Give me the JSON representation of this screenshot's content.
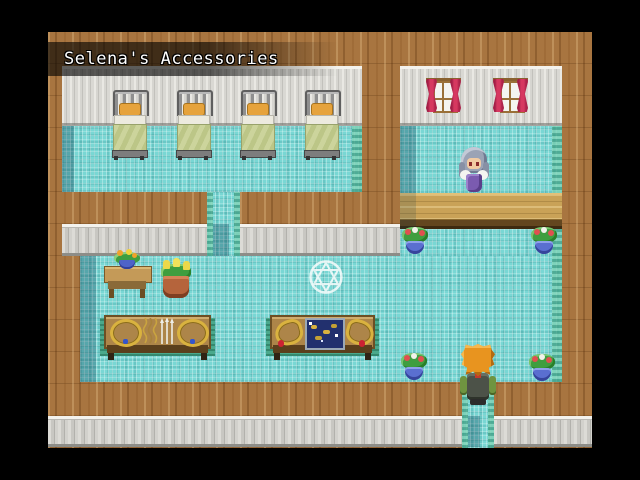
{
  "hud": {
    "map_name": "Selena's Accessories"
  },
  "scene": {
    "entities": {
      "beds": 4,
      "windows": 2,
      "flower_pots": 4,
      "display_tables": 2,
      "characters": [
        "shopkeeper",
        "player"
      ]
    }
  },
  "colors": {
    "wood": "#a87540",
    "wall": "#cfceca",
    "floor": "#79d7d4",
    "edge": "#3f9e82",
    "counter": "#c9a257",
    "curtain": "#d63860",
    "flower": "#e05050",
    "dress": "#7b5bb0",
    "hair": "#e8941f",
    "gold": "#d9b23f",
    "circle": "#ffffff"
  }
}
